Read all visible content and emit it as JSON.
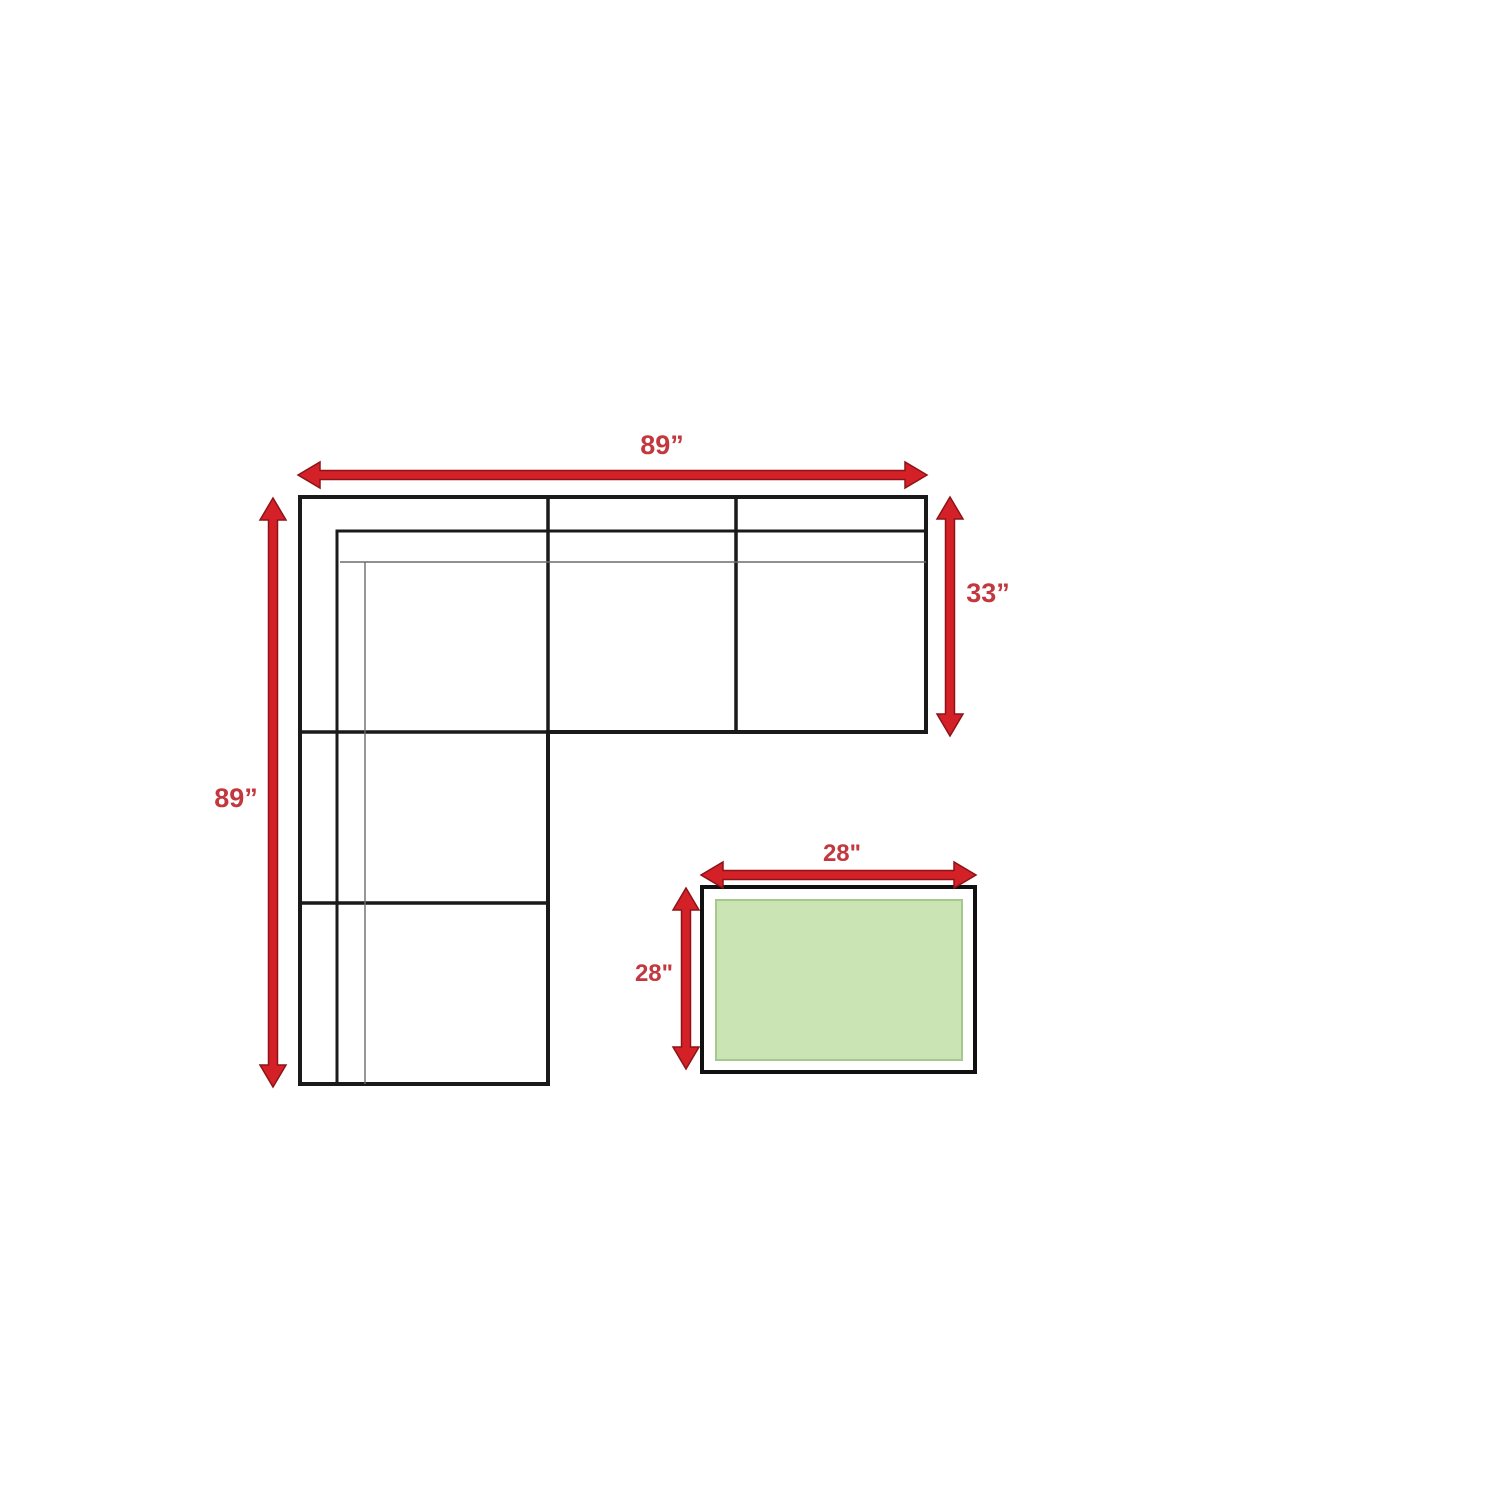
{
  "labels": {
    "sofa_width": "89”",
    "sofa_depth": "89”",
    "section_depth": "33”",
    "table_width": "28\"",
    "table_depth": "28\""
  },
  "colors": {
    "background": "#ffffff",
    "arrow_fill": "#d42127",
    "arrow_outline": "#8e1319",
    "label_text": "#c2383e",
    "sofa_outline": "#1a1a1a",
    "sofa_thin_line": "#6b6b6b",
    "table_border": "#111111",
    "table_top_fill": "#cbe4b4",
    "table_top_border": "#a6c78d"
  }
}
